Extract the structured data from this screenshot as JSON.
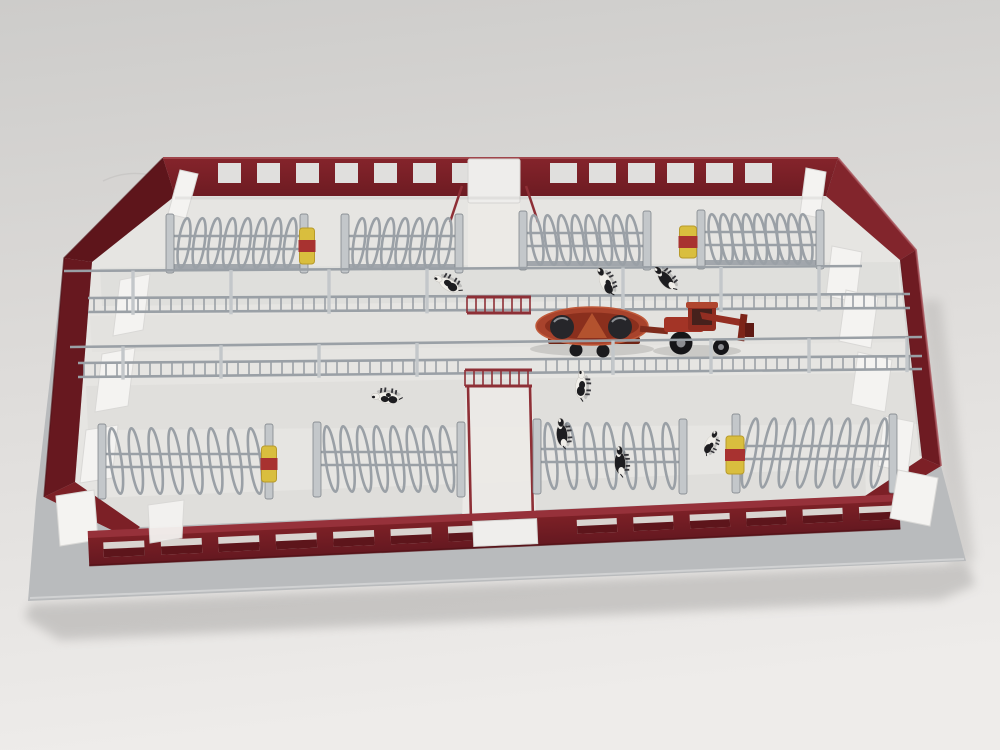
{
  "scene": {
    "type": "photograph",
    "subject": "Scale model of a dark-red free-stall cattle barn viewed from above on a light studio backdrop: open-top building with window strips in the walls, grey cubicle rows with loop dividers, feed fences along a central drive-through feeding passage, yellow cow brushes, miniature Holstein cows and a red tractor pulling a feed mixer wagon",
    "background": "plain light-grey seamless backdrop"
  },
  "colors": {
    "backdrop_top": "#cfcecd",
    "backdrop_bottom": "#edebe9",
    "base_gray": "#b9bbbd",
    "base_edge": "#cdcfd1",
    "wall_red": "#731d24",
    "wall_red_light": "#7e2027",
    "wall_red_dark": "#5e151b",
    "wall_red_side": "#67181f",
    "wall_red_front": "#7c2026",
    "wall_red_top": "#96313a",
    "floor": "#e6e5e2",
    "floor_alley": "#dcdbd8",
    "floor_lane": "#eceae7",
    "panel_white": "#f4f3f1",
    "panel_edge": "#d9d8d6",
    "steel": "#9aa0a6",
    "steel_light": "#c3c7ca",
    "steel_dark": "#767c82",
    "gate_red": "#8e2f36",
    "brush_yellow": "#d9be3e",
    "brush_red": "#a83230",
    "glass": "#e0dfdd",
    "window_dark": "#5d151b",
    "cow_white": "#f0eee9",
    "cow_black": "#1d1d20",
    "vehicle_red": "#a33426",
    "mixer_red": "#a8432c",
    "mixer_dark": "#8a2f1d"
  },
  "top_wall": {
    "window_groups": [
      {
        "start": 218,
        "count": 7,
        "pitch": 39,
        "width": 23,
        "y": 163,
        "height": 20
      },
      {
        "start": 550,
        "count": 6,
        "pitch": 39,
        "width": 27,
        "y": 163,
        "height": 20
      }
    ],
    "door": {
      "x": 468,
      "y": 159,
      "w": 52,
      "h": 44
    }
  },
  "front_wall": {
    "window_groups": [
      {
        "start": 15,
        "count": 7,
        "pitch": 57.5,
        "width": 41,
        "y": 5,
        "height": 15
      },
      {
        "start": 489,
        "count": 6,
        "pitch": 56.5,
        "width": 40,
        "y": 4,
        "height": 14
      }
    ],
    "door": {
      "x": 385,
      "y": 1,
      "w": 64,
      "h": 25
    }
  },
  "stall_rows": {
    "top": [
      {
        "x0": 166,
        "x1": 308,
        "count": 8,
        "lean": 8,
        "cy": 243,
        "ry": 25
      },
      {
        "x0": 341,
        "x1": 463,
        "count": 7,
        "lean": 8,
        "cy": 243,
        "ry": 25
      },
      {
        "x0": 519,
        "x1": 651,
        "count": 8,
        "lean": -8,
        "cy": 240,
        "ry": 25
      },
      {
        "x0": 697,
        "x1": 824,
        "count": 9,
        "lean": -8,
        "cy": 239,
        "ry": 25
      }
    ],
    "bottom": [
      {
        "x0": 98,
        "x1": 273,
        "count": 8,
        "lean": -8,
        "cy": 461,
        "ry": 33
      },
      {
        "x0": 313,
        "x1": 465,
        "count": 8,
        "lean": -8,
        "cy": 459,
        "ry": 33
      },
      {
        "x0": 533,
        "x1": 687,
        "count": 7,
        "lean": -6,
        "cy": 456,
        "ry": 33
      },
      {
        "x0": 732,
        "x1": 897,
        "count": 8,
        "lean": 10,
        "cy": 453,
        "ry": 35
      }
    ]
  },
  "fences": {
    "upper": {
      "x0": 88,
      "x1": 910,
      "pipe": [
        64,
        271,
        862,
        266
      ],
      "rail1": [
        298,
        294
      ],
      "rail2": [
        312,
        308
      ],
      "bar_pitch": 11,
      "post_step": 98,
      "gate": {
        "x0": 467,
        "x1": 531,
        "y0": 297,
        "y1": 313
      }
    },
    "lower": {
      "x0": 78,
      "x1": 922,
      "pipe": [
        70,
        347,
        922,
        337
      ],
      "rail1": [
        363,
        356
      ],
      "rail2": [
        377,
        369
      ],
      "bar_pitch": 11,
      "post_step": 98,
      "gate": {
        "x0": 465,
        "x1": 532,
        "y0": 370,
        "y1": 386
      },
      "lane_posts": {
        "x": [
          468,
          530
        ],
        "y0": 386,
        "y1": 522
      }
    }
  },
  "brushes": [
    {
      "x": 307,
      "y": 246,
      "w": 15,
      "h": 36
    },
    {
      "x": 688,
      "y": 242,
      "w": 17,
      "h": 32
    },
    {
      "x": 269,
      "y": 464,
      "w": 15,
      "h": 36
    },
    {
      "x": 735,
      "y": 455,
      "w": 18,
      "h": 38
    }
  ],
  "cows": [
    {
      "x": 449,
      "y": 285,
      "rot": -150,
      "pattern": "head-white",
      "s": 1,
      "layer": "upper"
    },
    {
      "x": 606,
      "y": 283,
      "rot": -115,
      "pattern": "front-white",
      "s": 1,
      "layer": "upper"
    },
    {
      "x": 666,
      "y": 280,
      "rot": -130,
      "pattern": "mostly-black",
      "s": 1,
      "layer": "upper"
    },
    {
      "x": 581,
      "y": 387,
      "rot": -88,
      "pattern": "head-white",
      "s": 1,
      "layer": "mid"
    },
    {
      "x": 388,
      "y": 398,
      "rot": 188,
      "pattern": "spots",
      "s": 1,
      "layer": "mid"
    },
    {
      "x": 562,
      "y": 435,
      "rot": -95,
      "pattern": "mostly-black",
      "s": 1,
      "layer": "bottom"
    },
    {
      "x": 620,
      "y": 463,
      "rot": -92,
      "pattern": "mostly-black",
      "s": 1,
      "layer": "bottom"
    },
    {
      "x": 710,
      "y": 444,
      "rot": -65,
      "pattern": "front-white",
      "s": 0.85,
      "layer": "bottom"
    }
  ],
  "vehicle": {
    "mixer": {
      "x": 592,
      "y": 326
    },
    "tractor": {
      "x": 694,
      "y": 328
    }
  }
}
